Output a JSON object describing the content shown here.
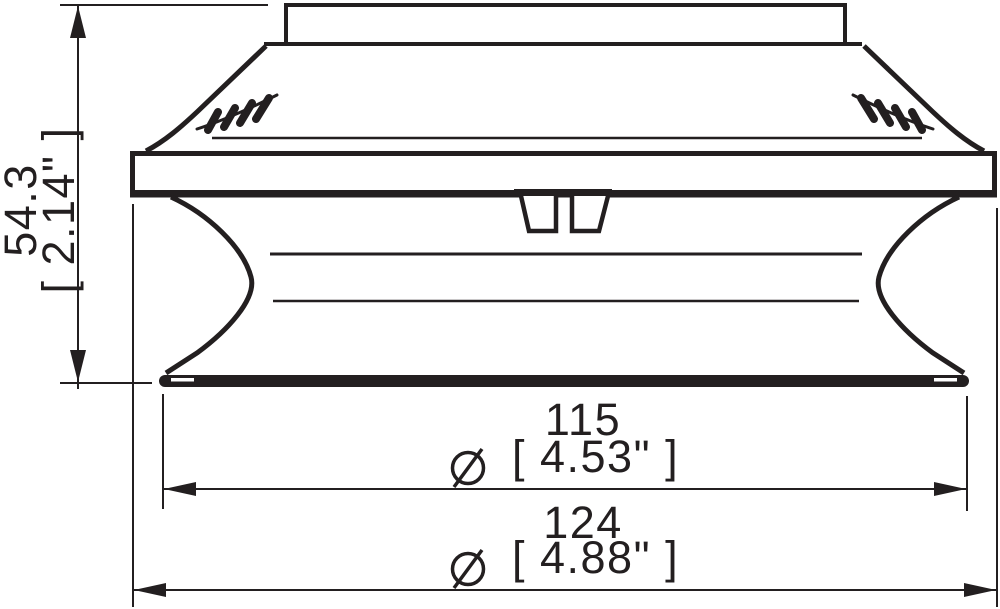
{
  "drawing": {
    "subject": "bellows suction cup, side profile technical drawing",
    "background": "#ffffff",
    "line_color": "#231f20",
    "dims": {
      "height": {
        "mm": "54.3",
        "inches": "[ 2.14\" ]"
      },
      "diameter_inner": {
        "symbol": "Ø",
        "mm": "115",
        "inches": "[ 4.53\" ]"
      },
      "diameter_outer": {
        "symbol": "Ø",
        "mm": "124",
        "inches": "[ 4.88\" ]"
      }
    }
  }
}
